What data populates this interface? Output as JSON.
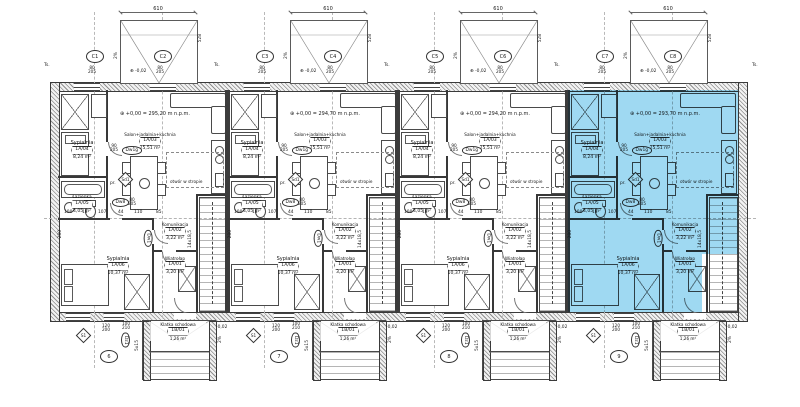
{
  "drawing": {
    "room_labels": {
      "sypialnia_top": {
        "name": "Sypialnia",
        "tag": "1A/04",
        "area": "8,24 m²"
      },
      "salon": {
        "name": "Salon+jadalnia+kuchnia",
        "tag": "1A/03",
        "area": "25,51 m²"
      },
      "lazienka": {
        "name": "Łazienka",
        "tag": "1A/05",
        "area": "4,05 m²"
      },
      "komunikacja": {
        "name": "Komunikacja",
        "tag": "1A/02",
        "area": "3,22 m²"
      },
      "wiatrolap": {
        "name": "Wiatrołap",
        "tag": "1A/01",
        "area": "3,20 m²"
      },
      "sypialnia_bottom": {
        "name": "Sypialnia",
        "tag": "1A/06",
        "area": "10,37 m²"
      },
      "klatka": {
        "name": "Klatka schodowa",
        "tag": "1B/01",
        "area": "1,26 m²"
      }
    },
    "door_tags": {
      "bedroom": "Dw1g",
      "bath": "Dw8",
      "hall": "Dw1",
      "living": "Dw1d",
      "entrance": "Dz1",
      "living_diamond": "Sd1",
      "marker": "S1"
    },
    "door_sizes": {
      "bedroom": [
        "90",
        "205"
      ],
      "bath": [
        "80",
        "205"
      ],
      "entrance": [
        "100",
        "210"
      ],
      "axis": [
        "120",
        "200"
      ],
      "window": [
        "80",
        "205"
      ]
    },
    "annotations": {
      "open_ceiling": "otwór w stropie",
      "washer": "pr.",
      "int_stairs": "14x18,5",
      "ext_stairs": "5x15",
      "slope": "2%",
      "minus_level": "-0,02",
      "terrace_width": "610",
      "terrace_depth": "528",
      "side_dim": "280",
      "ts": "Ts.",
      "level_symbol": "⊕"
    },
    "dims_row": [
      "100",
      "13",
      "107",
      "44",
      "110",
      "85"
    ],
    "units": [
      {
        "axis_left": "C1",
        "axis_right": "C2",
        "bottom_axis": "6",
        "level": "+0,00 = 295,20 m n.p.m.",
        "highlighted": false
      },
      {
        "axis_left": "C3",
        "axis_right": "C4",
        "bottom_axis": "7",
        "level": "+0,00 = 294,70 m n.p.m.",
        "highlighted": false
      },
      {
        "axis_left": "C5",
        "axis_right": "C6",
        "bottom_axis": "8",
        "level": "+0,00 = 294,20 m n.p.m.",
        "highlighted": false
      },
      {
        "axis_left": "C7",
        "axis_right": "C8",
        "bottom_axis": "9",
        "level": "+0,00 = 293,70 m n.p.m.",
        "highlighted": true
      }
    ],
    "colors": {
      "highlight": "#8ed3f0",
      "wall": "#3c3c3c",
      "hatch": "#8f8f8f",
      "line": "#555555"
    }
  }
}
